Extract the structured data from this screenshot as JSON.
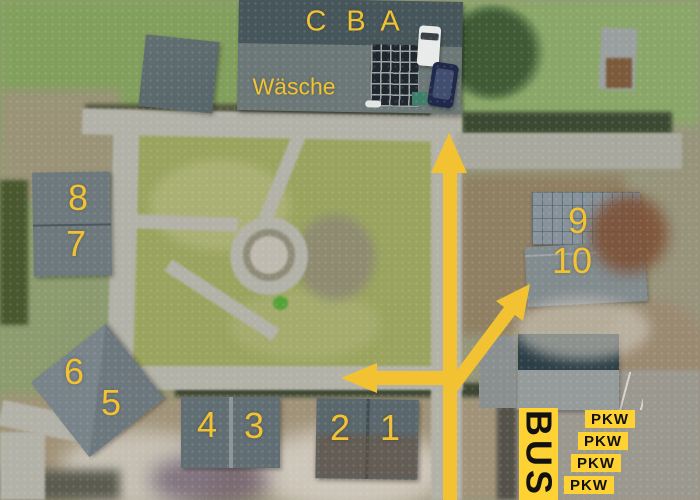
{
  "colors": {
    "annotation_yellow": "#F2C233",
    "sign_yellow": "#FFD233",
    "sign_text": "#111111"
  },
  "hall": {
    "sections": [
      "C",
      "B",
      "A"
    ],
    "laundry_label": "Wäsche"
  },
  "units": [
    "1",
    "2",
    "3",
    "4",
    "5",
    "6",
    "7",
    "8",
    "9",
    "10"
  ],
  "parking": {
    "bus_label": "BUS",
    "pkw_labels": [
      "PKW",
      "PKW",
      "PKW",
      "PKW"
    ]
  },
  "icons": {
    "arrow_up": "arrow-up-icon",
    "arrow_left": "arrow-left-icon",
    "arrow_up_right": "arrow-up-right-icon"
  }
}
